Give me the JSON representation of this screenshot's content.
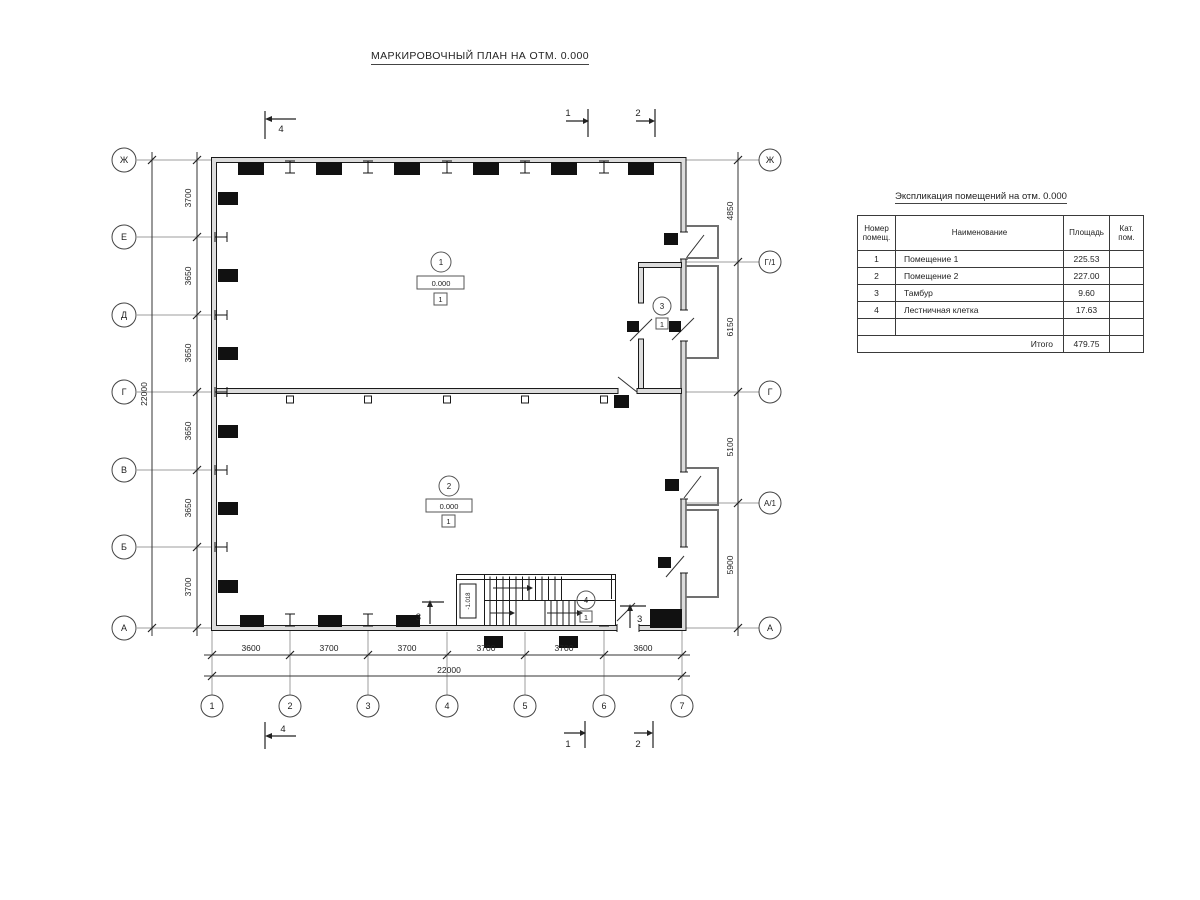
{
  "title": "МАРКИРОВОЧНЫЙ ПЛАН НА ОТМ. 0.000",
  "schedule": {
    "title": "Экспликация помещений на отм. 0.000",
    "headers": [
      "Номер помещ.",
      "Наименование",
      "Площадь",
      "Кат. пом."
    ],
    "rows": [
      {
        "num": "1",
        "name": "Помещение 1",
        "area": "225.53",
        "cat": ""
      },
      {
        "num": "2",
        "name": "Помещение 2",
        "area": "227.00",
        "cat": ""
      },
      {
        "num": "3",
        "name": "Тамбур",
        "area": "9.60",
        "cat": ""
      },
      {
        "num": "4",
        "name": "Лестничная клетка",
        "area": "17.63",
        "cat": ""
      },
      {
        "num": "",
        "name": "",
        "area": "",
        "cat": ""
      }
    ],
    "total_label": "Итого",
    "total_value": "479.75"
  },
  "axes": {
    "left": [
      "Ж",
      "Е",
      "Д",
      "Г",
      "В",
      "Б",
      "А"
    ],
    "right": [
      "Ж",
      "Г/1",
      "Г",
      "А/1",
      "А"
    ],
    "bottom": [
      "1",
      "2",
      "3",
      "4",
      "5",
      "6",
      "7"
    ]
  },
  "dims": {
    "left": [
      "3700",
      "3650",
      "3650",
      "3650",
      "3650",
      "3700"
    ],
    "left_total": "22000",
    "right": [
      "4850",
      "6150",
      "5100",
      "5900"
    ],
    "bottom": [
      "3600",
      "3700",
      "3700",
      "3700",
      "3700",
      "3600"
    ],
    "bottom_total": "22000"
  },
  "rooms": [
    {
      "num": "1",
      "elev": "0.000",
      "floor": "1"
    },
    {
      "num": "2",
      "elev": "0.000",
      "floor": "1"
    },
    {
      "num": "3",
      "floor": "1"
    },
    {
      "num": "4",
      "floor": "1"
    }
  ],
  "stair": {
    "elev": "-1.018"
  },
  "sections": {
    "s1": "1",
    "s2": "2",
    "s3": "3",
    "s4": "4"
  }
}
